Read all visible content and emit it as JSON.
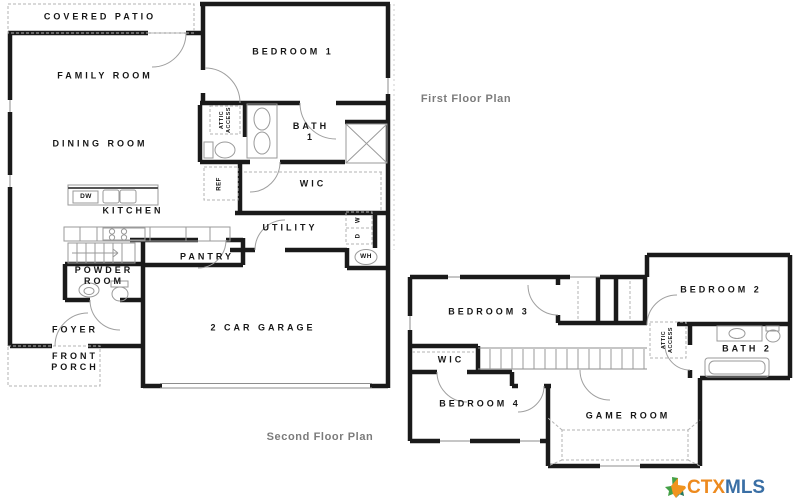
{
  "plan_titles": {
    "first_floor": "First Floor Plan",
    "second_floor": "Second Floor Plan"
  },
  "first_floor": {
    "covered_patio": "COVERED PATIO",
    "family_room": "FAMILY ROOM",
    "bedroom_1": "BEDROOM 1",
    "dining_room": "DINING ROOM",
    "attic_access": [
      "ATTIC",
      "ACCESS"
    ],
    "bath_1": [
      "BATH",
      "1"
    ],
    "wic": "WIC",
    "kitchen": "KITCHEN",
    "dishwasher": "DW",
    "refrigerator": "REF",
    "utility": "UTILITY",
    "washer": "W",
    "dryer": "D",
    "water_heater": "WH",
    "pantry": "PANTRY",
    "powder_room": [
      "POWDER",
      "ROOM"
    ],
    "foyer": "FOYER",
    "front_porch": [
      "FRONT",
      "PORCH"
    ],
    "garage": "2 CAR GARAGE"
  },
  "second_floor": {
    "bedroom_3": "BEDROOM 3",
    "bedroom_2": "BEDROOM 2",
    "bedroom_4": "BEDROOM 4",
    "game_room": "GAME ROOM",
    "wic": "WIC",
    "bath_2": "BATH 2",
    "attic_access": [
      "ATTIC",
      "ACCESS"
    ]
  },
  "watermark": {
    "ctx": "CTX",
    "mls": "MLS",
    "icon": "texas-state-icon"
  },
  "colors": {
    "wall": "#1a1a1a",
    "fixture": "#9a9a9a",
    "dashed": "#b3b3b3",
    "title_text": "#7b7b7b",
    "logo_ctx": "#ED8A1E",
    "logo_mls": "#3A6FA5"
  }
}
